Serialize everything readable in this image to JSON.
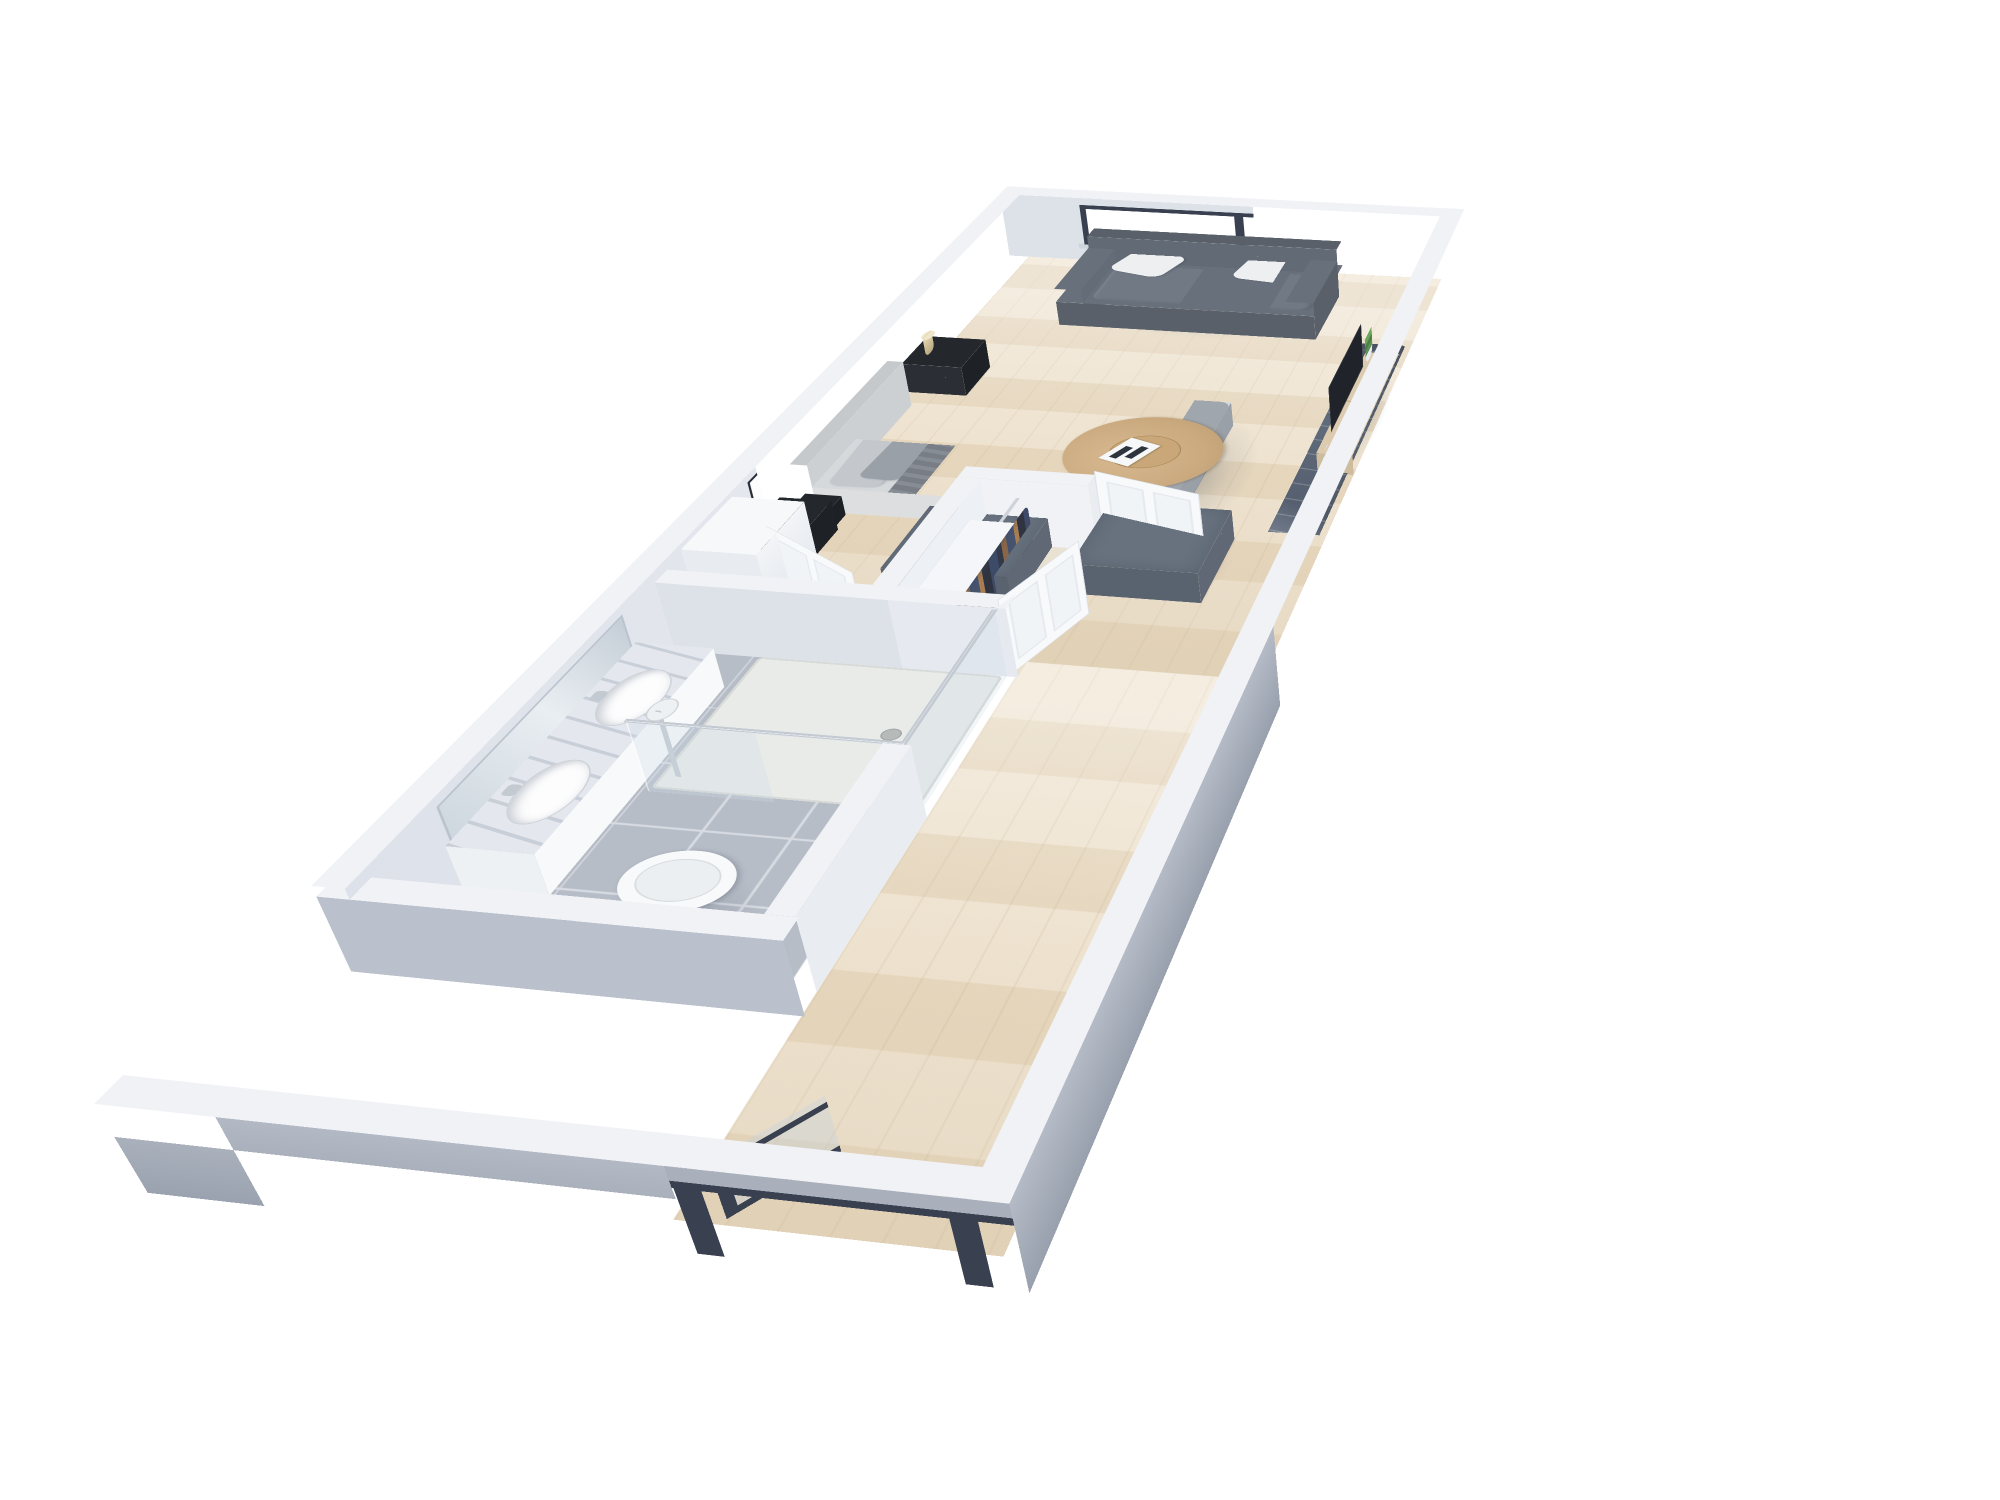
{
  "scene": {
    "type": "3d-floor-plan-render",
    "name": "studio-apartment",
    "view": "perspective-top-down",
    "background": "#ffffff",
    "dimensions_px": {
      "width": 2000,
      "height": 1500
    }
  },
  "palette": {
    "wall-top": "#f0f2f6",
    "wall-inner": "#e9ecf1",
    "wall-inner-dim": "#dde2e9",
    "wall-outer": "#a9b0bc",
    "wall-outer-dark": "#97a0ae",
    "wall-outer-light": "#bac1cc",
    "floor-wood": "#ecdfc9",
    "floor-wood-deep": "#e0cfb2",
    "tile": "#b7bdc7",
    "tile-line": "#d8dce2",
    "closet-wood": "#e9e2d2",
    "marble": "#e4e8ee",
    "marble-vein": "#aab3c1",
    "porcelain": "#f7f9fa",
    "headboard": "#c6c9cc",
    "bed-side": "#dcdee0",
    "pillow-light": "#c4c8cd",
    "pillow-dark": "#9aa0a7",
    "bed-sheet": "#d6d9db",
    "bed-throw": "#7e848d",
    "bed-quilt": "#f1f2f4",
    "bed-blanket": "#a0a6ad",
    "sofa": "#68707b",
    "sofa-dark": "#596069",
    "cushion": "#717985",
    "pillow-white": "#edeff1",
    "ottoman": "#68727f",
    "ottoman-dark": "#596370",
    "rug-dark": "#566070",
    "rug-light": "#d6dae1",
    "table-wood": "#cbaa80",
    "table-wood-dark": "#b09568",
    "console-wood": "#dccbaf",
    "tv-black": "#20242a",
    "nightstand": "#24272c",
    "lamp-shade": "#d8c7a3",
    "door-white": "#f7f9fb",
    "door-panel": "#e6eaef",
    "frame-dark": "#394050",
    "glass-tint": "#cfdbe4",
    "clothes-navy": "#3d4b68",
    "clothes-dark": "#333947",
    "clothes-brown": "#8a6648",
    "clothes-tan": "#a87d52",
    "plant-green": "#5f9355",
    "plant-dark": "#4d7f45",
    "chrome": "#c3cad2"
  },
  "rooms": [
    {
      "name": "bedroom-living-area",
      "floor": "light-wood",
      "contents": [
        "double-bed",
        "upholstered-headboard",
        "bed-pillows",
        "gray-throw-blanket",
        "white-quilt",
        "gray-foot-blanket",
        "wall-art-frame",
        "wall-art-frame",
        "wall-art-frame",
        "nightstand-left",
        "nightstand-right",
        "cylinder-table-lamp",
        "window-black-frame",
        "loveseat-sofa",
        "white-throw-pillow",
        "white-throw-pillow",
        "square-ottoman",
        "square-ottoman",
        "round-coffee-table",
        "coffee-table-book",
        "area-rug",
        "tv-console",
        "flat-screen-tv",
        "potted-plant",
        "sphere-floor-lamp",
        "white-dresser",
        "bedside-bag"
      ]
    },
    {
      "name": "bathroom",
      "floor": "gray-tile",
      "contents": [
        "double-sink-vanity",
        "marble-countertop",
        "vanity-mirror",
        "vanity-light",
        "faucet",
        "faucet",
        "toilet",
        "walk-in-shower",
        "shower-glass-panel",
        "shower-rail",
        "shower-head",
        "floor-drain"
      ]
    },
    {
      "name": "closet",
      "contents": [
        "hanging-clothes",
        "closet-shelf",
        "closet-rod",
        "closet-door-open",
        "closet-door-ajar"
      ]
    },
    {
      "name": "hallway-entry",
      "floor": "light-wood",
      "contents": [
        "entry-glass-door",
        "dark-door-frame"
      ]
    }
  ],
  "counts": {
    "wall_art_frames": 3,
    "window_panes": 2,
    "sinks": 2,
    "ottomans": 2,
    "sofa_seat_cushions": 2,
    "white_panel_doors": 3,
    "glass_entry_doors": 1
  }
}
